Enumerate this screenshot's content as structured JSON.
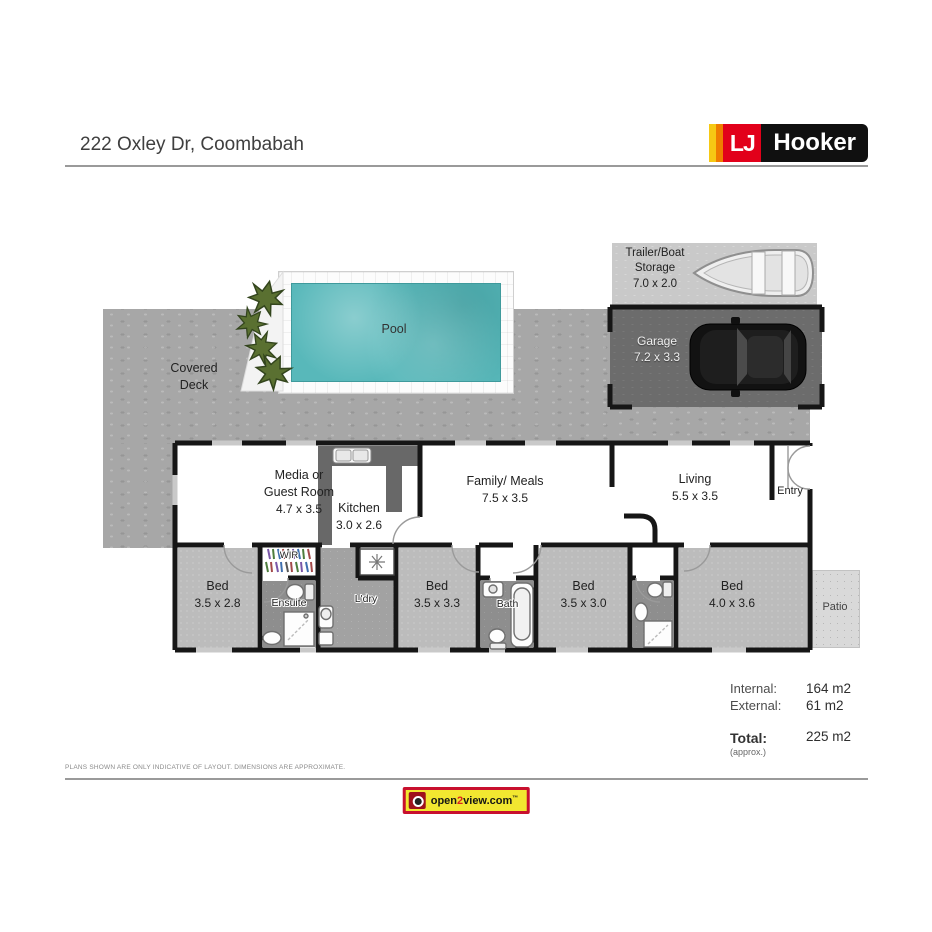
{
  "header": {
    "title": "222 Oxley Dr, Coombabah",
    "brand_lj": "LJ",
    "brand_name": "Hooker"
  },
  "outdoor": {
    "deck_line1": "Covered",
    "deck_line2": "Deck",
    "pool": "Pool",
    "trailer_line1": "Trailer/Boat",
    "trailer_line2": "Storage",
    "trailer_dims": "7.0 x 2.0",
    "garage": "Garage",
    "garage_dims": "7.2 x 3.3",
    "patio": "Patio"
  },
  "rooms": {
    "media_line1": "Media or",
    "media_line2": "Guest Room",
    "media_dims": "4.7 x 3.5",
    "kitchen": "Kitchen",
    "kitchen_dims": "3.0 x 2.6",
    "family": "Family/ Meals",
    "family_dims": "7.5 x 3.5",
    "living": "Living",
    "living_dims": "5.5 x 3.5",
    "entry": "Entry",
    "bed1": "Bed",
    "bed1_dims": "3.5 x 2.8",
    "ensuite": "Ensuite",
    "wir": "WIR",
    "ldry": "L'dry",
    "bed2": "Bed",
    "bed2_dims": "3.5 x 3.3",
    "bath": "Bath",
    "bed3": "Bed",
    "bed3_dims": "3.5 x 3.0",
    "bed4": "Bed",
    "bed4_dims": "4.0 x 3.6"
  },
  "areas": {
    "internal_label": "Internal:",
    "internal_value": "164 m2",
    "external_label": "External:",
    "external_value": "61 m2",
    "total_label": "Total:",
    "total_approx": "(approx.)",
    "total_value": "225 m2"
  },
  "footer": {
    "disclaimer": "PLANS SHOWN ARE ONLY INDICATIVE OF LAYOUT. DIMENSIONS ARE APPROXIMATE.",
    "watermark_pre": "open",
    "watermark_two": "2",
    "watermark_post": "view.com",
    "watermark_mark": "™"
  },
  "colors": {
    "pool_water": "#58b8ba",
    "deck": "#a7a7a7",
    "garage_floor": "#6c6c6c",
    "storage_floor": "#c9c9c9",
    "carpet": "#bcbcbc",
    "wet_floor": "#8e8e8e",
    "patio": "#d9d9d9",
    "wall": "#161616",
    "brand_red": "#e2001a",
    "brand_yellow": "#f6c914",
    "brand_orange": "#ef7d00",
    "watermark_red": "#c8102e",
    "watermark_yellow": "#f2e730"
  }
}
